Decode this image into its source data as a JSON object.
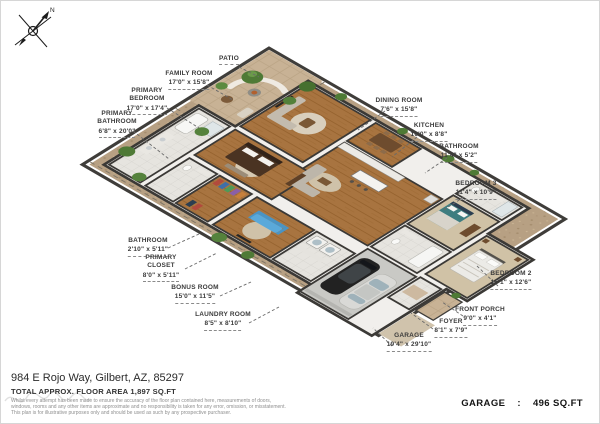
{
  "compass": {
    "north": "N"
  },
  "labels": [
    {
      "id": "patio",
      "name": "PATIO",
      "dims": ""
    },
    {
      "id": "family-room",
      "name": "FAMILY ROOM",
      "dims": "17'0\" x 15'8\""
    },
    {
      "id": "primary-bedroom",
      "name": "PRIMARY BEDROOM",
      "dims": "17'0\" x 17'4\""
    },
    {
      "id": "primary-bathroom",
      "name": "PRIMARY BATHROOM",
      "dims": "6'8\" x 20'0\""
    },
    {
      "id": "dining-room",
      "name": "DINING ROOM",
      "dims": "7'6\" x 15'8\""
    },
    {
      "id": "kitchen",
      "name": "KITCHEN",
      "dims": "16'0\" x 8'8\""
    },
    {
      "id": "bathroom-1",
      "name": "BATHROOM",
      "dims": "11'4\" x 5'2\""
    },
    {
      "id": "bedroom-3",
      "name": "BEDROOM 3",
      "dims": "11'4\" x 10'9\""
    },
    {
      "id": "bedroom-2",
      "name": "BEDROOM 2",
      "dims": "15'1\" x 12'6\""
    },
    {
      "id": "bathroom-2",
      "name": "BATHROOM",
      "dims": "2'10\" x 5'11\""
    },
    {
      "id": "primary-closet",
      "name": "PRIMARY CLOSET",
      "dims": "8'0\" x 5'11\""
    },
    {
      "id": "bonus-room",
      "name": "BONUS ROOM",
      "dims": "15'0\" x 11'5\""
    },
    {
      "id": "laundry-room",
      "name": "LAUNDRY ROOM",
      "dims": "8'5\" x 8'10\""
    },
    {
      "id": "front-porch",
      "name": "FRONT PORCH",
      "dims": "9'0\" x 4'1\""
    },
    {
      "id": "foyer",
      "name": "FOYER",
      "dims": "8'1\" x 7'9\""
    },
    {
      "id": "garage",
      "name": "GARAGE",
      "dims": "19'4\" x 29'10\""
    }
  ],
  "footer": {
    "address": "984 E Rojo Way, Gilbert, AZ, 85297",
    "total_area": "TOTAL APPROX. FLOOR AREA 1,897 SQ.FT",
    "disclaimer": [
      "Whilst every attempt has been made to ensure the accuracy of the floor plan contained here, measurements of doors,",
      "windows, rooms and any other items are approximate and no responsibility is taken for any error, omission, or misstatement.",
      "This plan is for illustrative purposes only and should be used as such by any prospective purchaser."
    ]
  },
  "summary": {
    "garage_label": "GARAGE",
    "separator": ":",
    "garage_value": "496 SQ.FT"
  },
  "palette": {
    "dirt": "#b7a083",
    "grass": "#8ba65a",
    "wood_floor": "#a87440",
    "tile_floor": "#e6e4df",
    "garage_floor": "#c9c9c5",
    "wall": "#3b3936",
    "accent_sofa_blue": "#5aa9da",
    "label_text": "#3b3b3b"
  }
}
